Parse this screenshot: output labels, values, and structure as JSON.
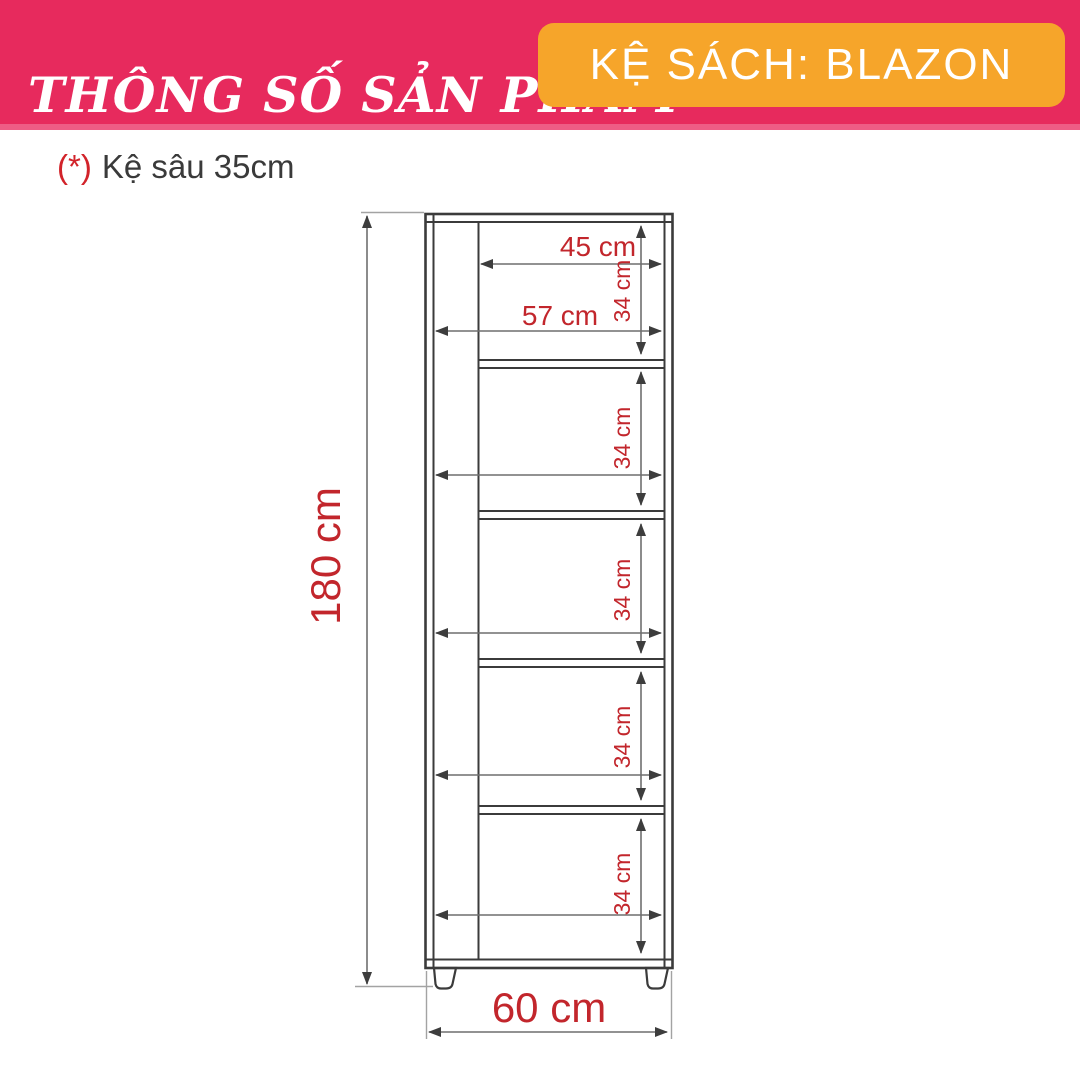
{
  "header": {
    "title": "THÔNG SỐ SẢN PHẨM",
    "product_label": "KỆ SÁCH: BLAZON",
    "bg_color": "#E72A5D",
    "badge_color": "#F6A52A"
  },
  "note": {
    "marker": "(*)",
    "text": "Kệ sâu 35cm"
  },
  "diagram": {
    "type": "furniture-dimension-drawing",
    "product": "bookshelf",
    "accent_color": "#C2262C",
    "line_color": "#3B3B3B",
    "dimension_line_color": "#6F6F6F",
    "labels": {
      "height": "180 cm",
      "width": "60 cm",
      "top_inner_width": "45 cm",
      "inner_width": "57 cm"
    },
    "shelf_heights": [
      "34 cm",
      "34 cm",
      "34 cm",
      "34 cm",
      "34 cm"
    ],
    "measurements": {
      "height_cm": 180,
      "width_cm": 60,
      "depth_cm": 35,
      "inner_width_cm": 57,
      "top_inner_width_cm": 45,
      "compartment_height_cm": 34,
      "compartments": 5
    }
  }
}
